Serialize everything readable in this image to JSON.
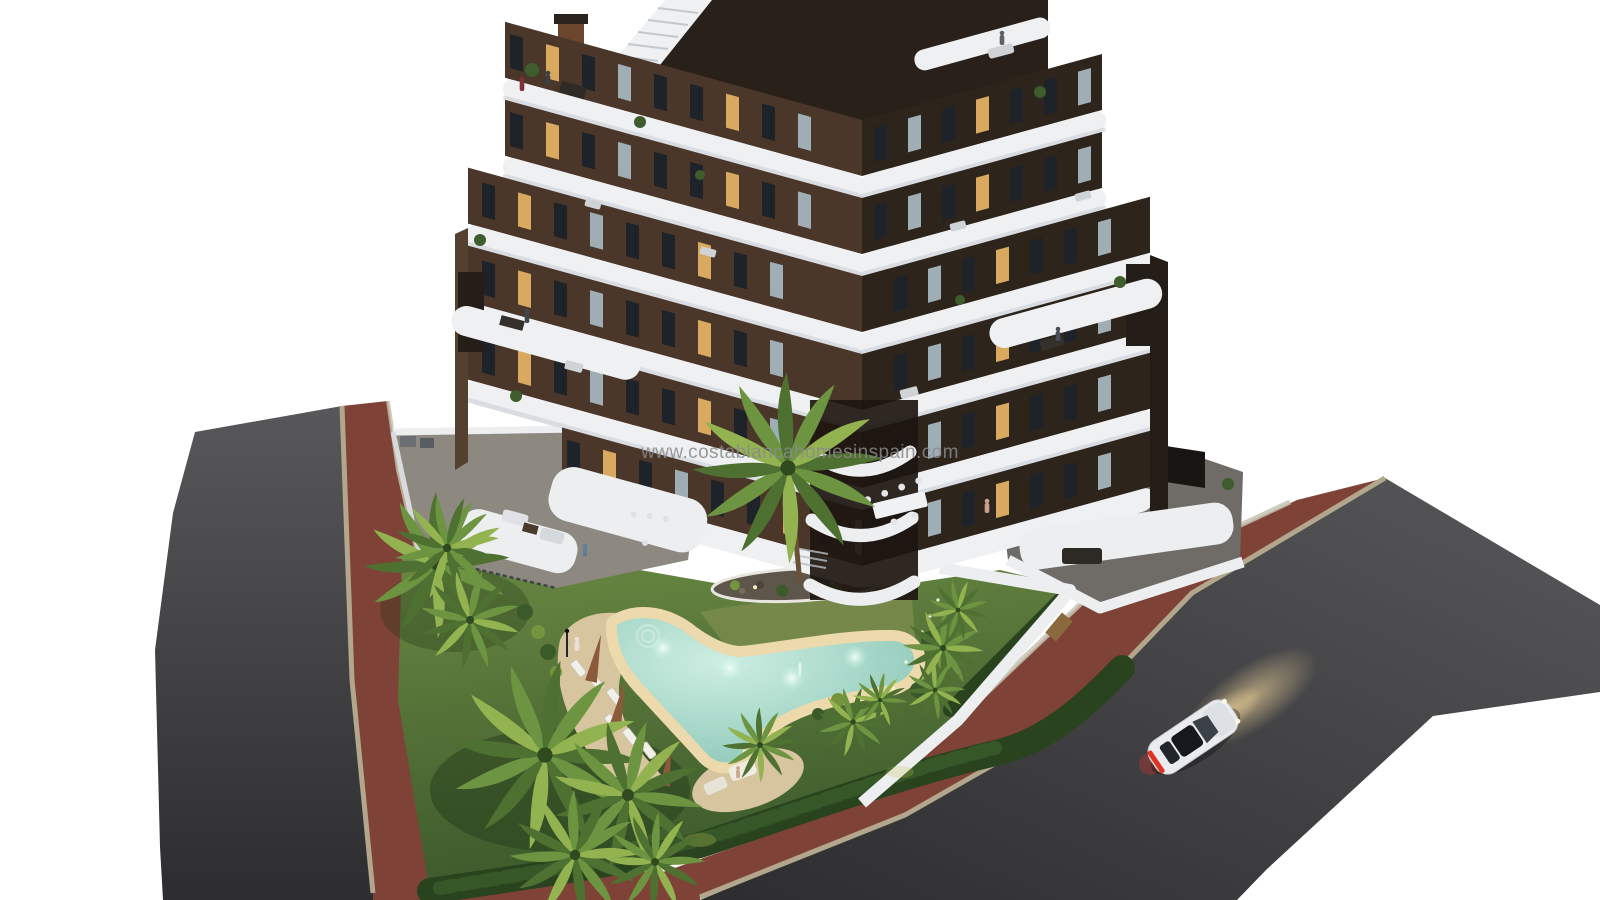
{
  "watermark": {
    "text": "www.costablancahomesinspain.com"
  },
  "scene": {
    "description": "Aerial dusk 3D render of a modern V-shaped apartment building with dark brown facade and curved white balcony bands, landscaped garden, free-form pool with underwater lights, palm trees, corner plot bordered by two asphalt roads with red paved sidewalks, and a white car driving with headlights on.",
    "building": {
      "floors_visible": 6,
      "facade": "dark brown",
      "balconies": "white curved bands",
      "roof": "terraces with stair and chimneys"
    },
    "pool": {
      "shape": "freeform boomerang",
      "underwater_lights": 4,
      "loungers": 6,
      "umbrellas": 3,
      "state": "illuminated"
    },
    "car": {
      "color": "white",
      "state": "driving, headlights on, brake lights lit"
    },
    "roads": {
      "count": 2,
      "surface": "dark asphalt",
      "sidewalk": "red brick pavers"
    },
    "garden": {
      "lawn": true,
      "hedge_border": true,
      "palm_trees": 14,
      "island_bed": 1
    }
  },
  "colors": {
    "bg": "#ffffff",
    "watermark": "#8a8a8a",
    "facadeL": "#4a3729",
    "facadeR": "#2d241c",
    "roofDark": "#29201a",
    "band": "#eef0f2",
    "bandShadow": "#c9cdd3",
    "winDark": "#1d2329",
    "winWarm": "#d8a95e",
    "winCool": "#9fadb5",
    "chimneyRust": "#6b452c",
    "roadTop": "#58585a",
    "roadBot": "#2d2d2f",
    "brick": "#7f4236",
    "curb": "#b2a78c",
    "verge": "#c6c2b2",
    "lawnLight": "#6c8a43",
    "lawnDark": "#3b592b",
    "meadow": "#79894b",
    "hedge": "#2a431f",
    "bushDark": "#3a5a2a",
    "bushLight": "#74943e",
    "palmA": "#4e7030",
    "palmB": "#6d9440",
    "palmC": "#92b350",
    "trunk": "#6b5136",
    "deck": "#d7c5a0",
    "deckLit": "#ecd9ac",
    "waterEdge": "#cdeee2",
    "waterDeep": "#85c3b2",
    "island": "#5e564a",
    "pavement": "#8d8880",
    "tiles": "#6f6b66",
    "wallWhite": "#eceef0",
    "carBody": "#e9ebee",
    "carGlass": "#2b3238",
    "tailRed": "#e03224",
    "glowWarm": "#f0d49a",
    "lightDot": "#ffeec2"
  }
}
